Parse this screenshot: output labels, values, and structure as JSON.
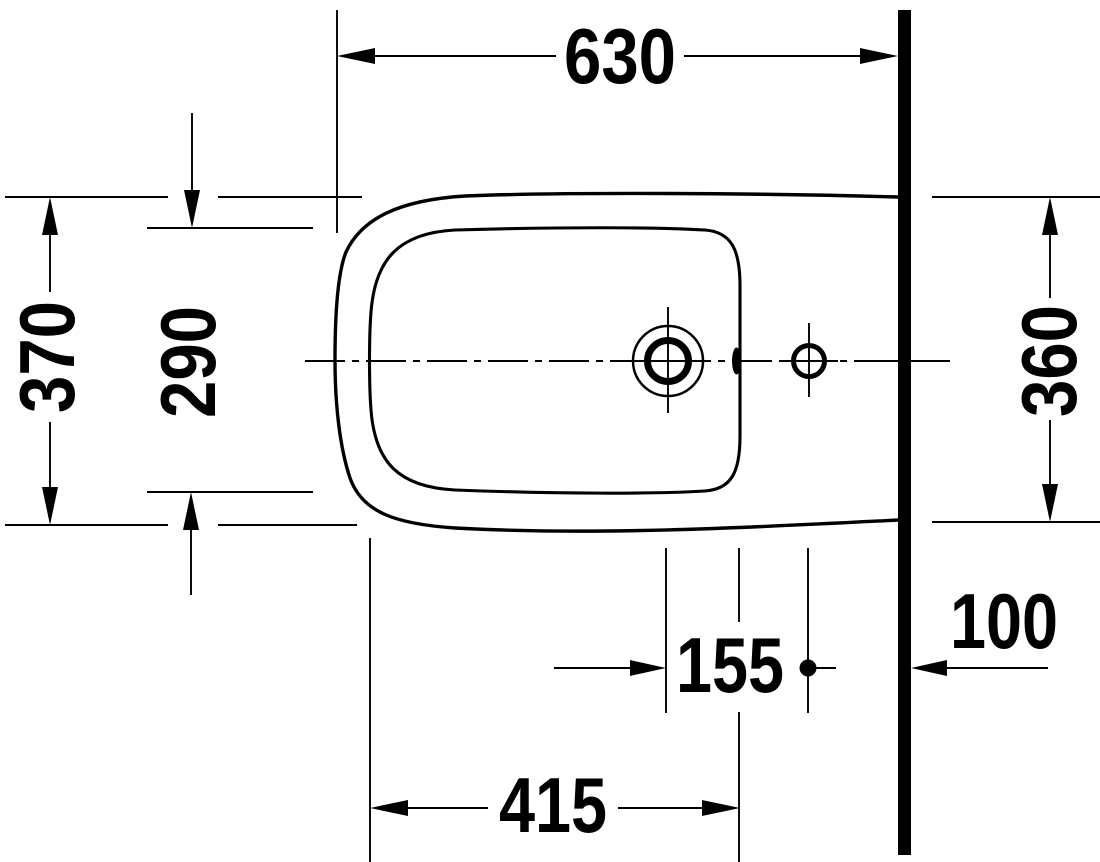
{
  "drawing": {
    "description": "Technical plan-view (top view) drawing of a wall-mounted bidet with one tap hole, a side hole and a back wall line",
    "background_color": "#ffffff",
    "line_color": "#000000"
  },
  "dimensions": {
    "overall_width": {
      "label": "630"
    },
    "overall_depth": {
      "label": "370"
    },
    "inner_rim_depth": {
      "label": "290"
    },
    "depth_at_wall": {
      "label": "360"
    },
    "tap_to_side_hole": {
      "label": "155"
    },
    "side_hole_to_wall": {
      "label": "100"
    },
    "inner_basin_length": {
      "label": "415"
    }
  }
}
